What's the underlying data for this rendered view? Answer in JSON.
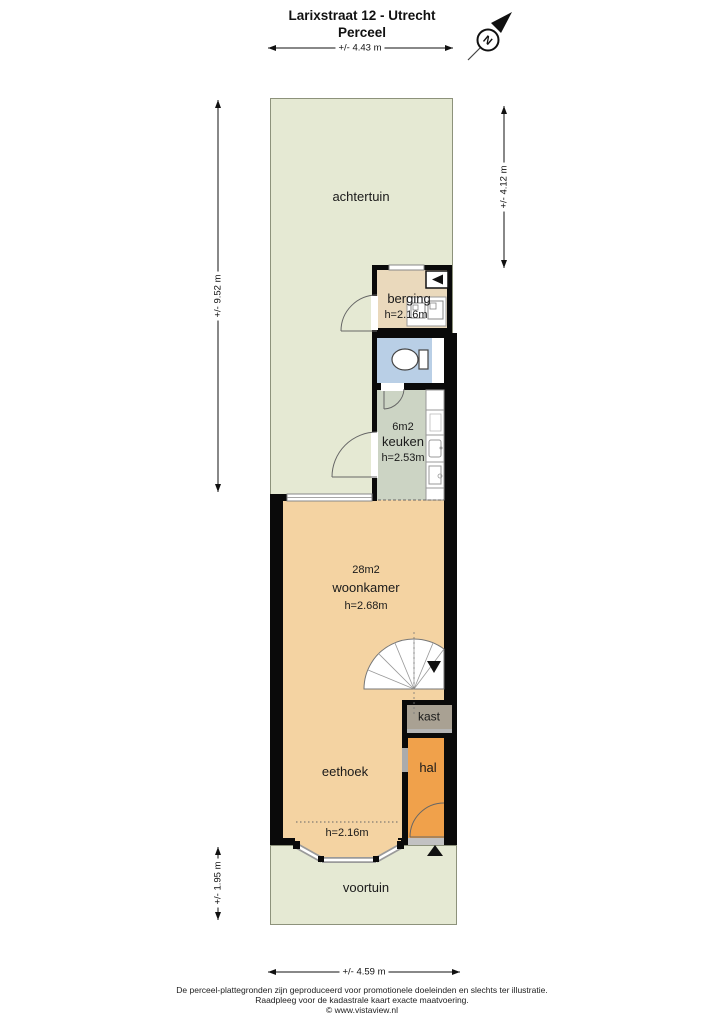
{
  "header": {
    "title": "Larixstraat 12 - Utrecht",
    "subtitle": "Perceel"
  },
  "compass": {
    "north_label": "N"
  },
  "dimensions": {
    "top": "+/- 4.43 m",
    "garden_left": "+/- 9.52 m",
    "garden_right": "+/- 4.12 m",
    "front_left": "+/- 1.95 m",
    "bottom": "+/- 4.59 m"
  },
  "rooms": {
    "achtertuin": {
      "name": "achtertuin"
    },
    "berging": {
      "name": "berging",
      "ceiling": "h=2.16m"
    },
    "keuken": {
      "area": "6m2",
      "name": "keuken",
      "ceiling": "h=2.53m"
    },
    "woonkamer": {
      "area": "28m2",
      "name": "woonkamer",
      "ceiling": "h=2.68m"
    },
    "eethoek": {
      "name": "eethoek",
      "bay_ceiling": "h=2.16m"
    },
    "kast": {
      "name": "kast"
    },
    "hal": {
      "name": "hal"
    },
    "voortuin": {
      "name": "voortuin"
    }
  },
  "colors": {
    "garden": "#e5e9d3",
    "garden_border": "#8d927b",
    "berging": "#ead9bc",
    "toilet": "#b9cfe6",
    "keuken": "#ccd4c4",
    "woonkamer": "#f4d3a2",
    "hal": "#f0a14b",
    "kast": "#a9a193",
    "wall": "#0a0a0a"
  },
  "footer": {
    "line1": "De perceel-plattegronden zijn geproduceerd voor promotionele doeleinden en slechts ter illustratie.",
    "line2": "Raadpleeg voor de kadastrale kaart exacte maatvoering.",
    "line3": "© www.vistaview.nl"
  }
}
